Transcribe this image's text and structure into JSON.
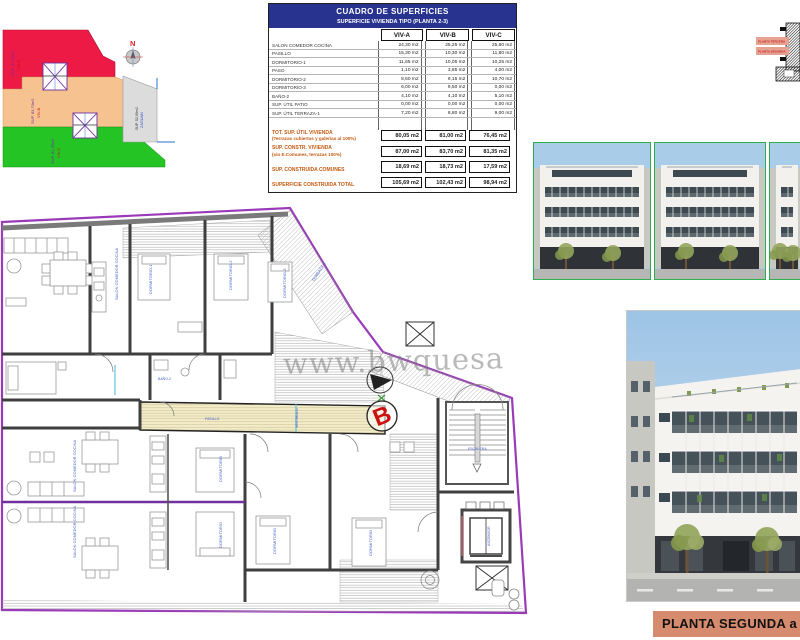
{
  "site_plan": {
    "north_label": "N",
    "areas": [
      {
        "id": "viv-a",
        "label": "VIV-A",
        "sup": "SUP. 87,00m2",
        "color": "#ed1a45"
      },
      {
        "id": "viv-b",
        "label": "VIV-B",
        "sup": "SUP. 83,70m2",
        "color": "#f6c290"
      },
      {
        "id": "viv-c",
        "label": "VIV-C",
        "sup": "SUP. 81,35m2",
        "color": "#25c425"
      },
      {
        "id": "zaguan",
        "label": "ZAGUAN",
        "sup": "SUP. 52,09m2",
        "color": "#dcdcdc"
      }
    ]
  },
  "surface_table": {
    "title": "CUADRO DE SUPERFICIES",
    "subtitle": "SUPERFICIE VIVIENDA TIPO  (PLANTA 2-3)",
    "columns": [
      "VIV-A",
      "VIV-B",
      "VIV-C"
    ],
    "rows": [
      {
        "label": "SALON COMEDOR COCINA",
        "values": [
          "24,30 m2",
          "25,25 m2",
          "25,60 m2"
        ]
      },
      {
        "label": "PASILLO",
        "values": [
          "15,30 m2",
          "10,30 m2",
          "11,80 m2"
        ]
      },
      {
        "label": "DORMITORIO-1",
        "values": [
          "11,65 m2",
          "10,05 m2",
          "10,25 m2"
        ]
      },
      {
        "label": "PASO",
        "values": [
          "1,10 m2",
          "3,85 m2",
          "4,00 m2"
        ]
      },
      {
        "label": "DORMITORIO-2",
        "values": [
          "8,60 m2",
          "9,15 m2",
          "10,70 m2"
        ]
      },
      {
        "label": "DORMITORIO-3",
        "values": [
          "6,00 m2",
          "9,50 m2",
          "0,00 m2"
        ]
      },
      {
        "label": "BAÑO-2",
        "values": [
          "4,10 m2",
          "4,10 m2",
          "5,10 m2"
        ]
      },
      {
        "label": "SUP. ÚTIL PATIO",
        "values": [
          "0,00 m2",
          "0,00 m2",
          "0,00 m2"
        ]
      },
      {
        "label": "SUP. ÚTIL TERRAZA-1",
        "values": [
          "7,20 m2",
          "8,80 m2",
          "9,00 m2"
        ]
      }
    ],
    "summary_rows": [
      {
        "label": "TOT. SUP. ÚTIL VIVIENDA",
        "sublabel": "(Terrazas cubiertas y galerías al 100%)",
        "values": [
          "80,05 m2",
          "81,00 m2",
          "76,45 m2"
        ]
      },
      {
        "label": "SUP. CONSTR. VIVIENDA",
        "sublabel": "(sin E.Comunes, terrazas 100%)",
        "values": [
          "87,00 m2",
          "83,70 m2",
          "81,35 m2"
        ]
      },
      {
        "label": "SUP. CONSTRUIDA COMUNES",
        "sublabel": "",
        "values": [
          "18,69 m2",
          "18,73 m2",
          "17,59 m2"
        ]
      },
      {
        "label": "SUPERFICIE CONSTRUIDA TOTAL",
        "sublabel": "",
        "values": [
          "105,69 m2",
          "102,43 m2",
          "98,94 m2"
        ]
      }
    ]
  },
  "section_diagram": {
    "labels": [
      "PLANTA TERCERA",
      "PLANTA SEGUNDA"
    ]
  },
  "floor_plan": {
    "watermark": "www.bwquesa",
    "marker_b": "B",
    "room_labels": [
      "SALON COMEDOR COCINA",
      "DORMITORIO-1",
      "DORMITORIO-2",
      "DORMITORIO-3",
      "TERRAZA-1",
      "BAÑO-2",
      "PASILLO",
      "VESTIBULO",
      "SALON COMEDOR COCINA",
      "SALON COMEDOR COCINA",
      "DORMITORIO",
      "DORMITORIO",
      "DORMITORIO",
      "DORMITORIO",
      "ESCALERA",
      "ASCENSOR"
    ]
  },
  "footer": {
    "label": "PLANTA SEGUNDA a"
  },
  "colors": {
    "header_navy": "#27338f",
    "summary_orange": "#c55a11",
    "boundary_purple": "#9a3ab8",
    "corridor_cream": "#f3ecc8",
    "marker_red": "#cc1111",
    "room_label_blue": "#4962c9",
    "render_border_green": "#2fae4e",
    "footer_salmon": "#d68a6e"
  }
}
